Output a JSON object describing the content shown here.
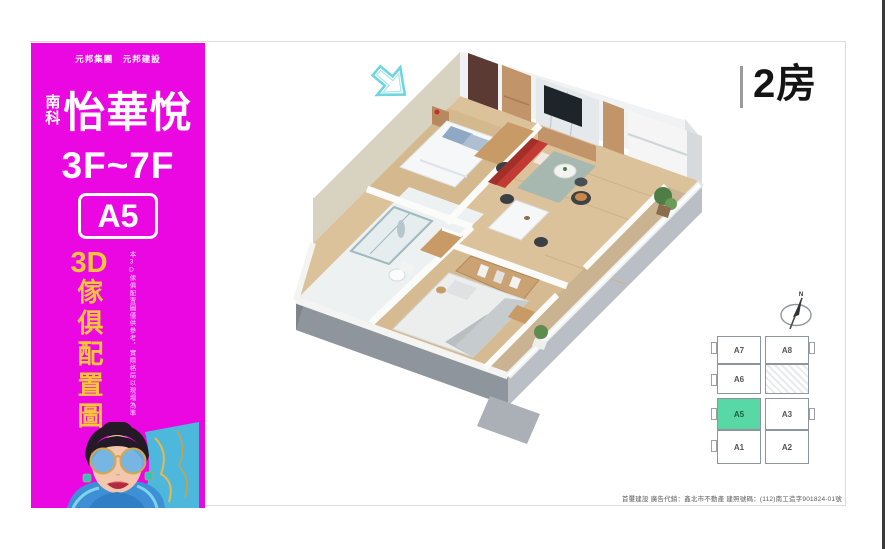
{
  "sidebar": {
    "corp_line": "元邦集團　元邦建設",
    "brand_prefix": "南科",
    "brand_name": "怡華悅",
    "floors": "3F~7F",
    "unit_badge": "A5",
    "vertical_title": {
      "prefix": "3D",
      "rest": "傢俱配置圖"
    },
    "vertical_note": "本3D傢俱配置圖僅供參考，實際格局以現場為準",
    "colors": {
      "background": "#EA07E2",
      "title_yellow": "#F5C63C"
    }
  },
  "main": {
    "room_type_label": "2房",
    "keyplan": {
      "compass_label": "N",
      "highlighted_unit": "A5",
      "highlight_color": "#58D8A4",
      "units": [
        {
          "label": "A7"
        },
        {
          "label": "A6"
        },
        {
          "label": "A5"
        },
        {
          "label": "A1"
        },
        {
          "label": "A8"
        },
        {
          "label": "A3"
        },
        {
          "label": "A2"
        }
      ]
    },
    "disclaimer": "首璽建設 廣告代銷：鑫北市不動產 建照號碼：(112)南工造字901824-01號"
  }
}
